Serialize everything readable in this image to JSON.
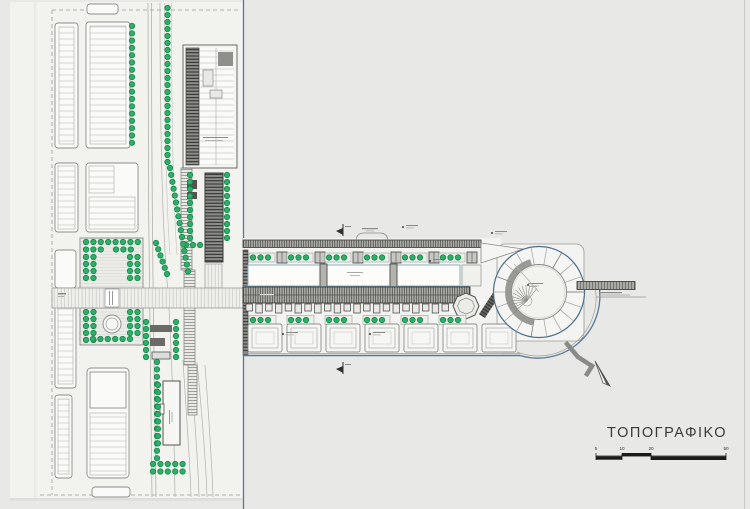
{
  "title": {
    "text": "ΤΟΠΟΓΡΑΦΙΚΟ"
  },
  "scale_bar": {
    "labels": [
      "5",
      "10",
      "20",
      "50"
    ]
  },
  "colors": {
    "background": "#e8e8e6",
    "paper": "#f2f2ef",
    "block_fill": "#fafaf8",
    "block_stroke": "#8e8e8a",
    "tree_fill": "#2fae68",
    "tree_stroke": "#15894c",
    "quay_blue": "#56789a",
    "hall_blue": "#8fb0c4",
    "dark_ink": "#3a3a38",
    "mid_ink": "#8a8a86",
    "scale_ink": "#1a1a1a"
  },
  "plan": {
    "tree_rows": [
      [
        132,
        26,
        0,
        7.3,
        17
      ],
      [
        167.5,
        8,
        0,
        7,
        23
      ],
      [
        186,
        245,
        7,
        0,
        3
      ],
      [
        190,
        175,
        0,
        7,
        10
      ],
      [
        227,
        175,
        0,
        7,
        10
      ],
      [
        170,
        168,
        1.2,
        6.9,
        16
      ],
      [
        156,
        243,
        2.2,
        6.2,
        6
      ],
      [
        146,
        322,
        0,
        7,
        6
      ],
      [
        176,
        322,
        0,
        7,
        6
      ],
      [
        86,
        242,
        7.4,
        0,
        8
      ],
      [
        86,
        249.5,
        7.4,
        0,
        3
      ],
      [
        116,
        249.5,
        7.4,
        0,
        3
      ],
      [
        86,
        257,
        0,
        7,
        4
      ],
      [
        93.5,
        257,
        0,
        7,
        4
      ],
      [
        130,
        257,
        0,
        7,
        4
      ],
      [
        137.5,
        257,
        0,
        7,
        4
      ],
      [
        86,
        312,
        0,
        7,
        5
      ],
      [
        93.5,
        312,
        0,
        7,
        5
      ],
      [
        130,
        312,
        0,
        7,
        4
      ],
      [
        137.5,
        312,
        0,
        7,
        4
      ],
      [
        93,
        339,
        7.4,
        0,
        6
      ],
      [
        157,
        362,
        0,
        7.4,
        14
      ],
      [
        153,
        464,
        7.4,
        0,
        5
      ],
      [
        153,
        471.5,
        7.4,
        0,
        5
      ],
      [
        158,
        385,
        0,
        7.3,
        9
      ],
      [
        253,
        257.5,
        7.5,
        0,
        3
      ],
      [
        291,
        257.5,
        7.5,
        0,
        3
      ],
      [
        329,
        257.5,
        7.5,
        0,
        3
      ],
      [
        367,
        257.5,
        7.5,
        0,
        3
      ],
      [
        405,
        257.5,
        7.5,
        0,
        3
      ],
      [
        443,
        257.5,
        7.5,
        0,
        3
      ],
      [
        253,
        320,
        7.5,
        0,
        3
      ],
      [
        291,
        320,
        7.5,
        0,
        3
      ],
      [
        329,
        320,
        7.5,
        0,
        3
      ],
      [
        367,
        320,
        7.5,
        0,
        3
      ],
      [
        405,
        320,
        7.5,
        0,
        3
      ],
      [
        443,
        320,
        7.5,
        0,
        3
      ]
    ],
    "platform_xs": [
      250,
      288,
      326,
      364,
      402,
      440
    ],
    "bay_squares": {
      "xs": [
        248,
        287,
        326,
        365,
        404,
        443,
        482
      ],
      "y": 324,
      "size": 34
    },
    "shops": {
      "x0": 246,
      "step": 9.8,
      "n": 21,
      "y": 304,
      "w": 6.5,
      "h": 9
    },
    "circle_building": {
      "cx": 539,
      "cy": 292,
      "r_outer": 45.5,
      "r_inner": 27.5,
      "spokes": 18
    },
    "fan": {
      "cx": 527,
      "cy": 301,
      "r": 16,
      "a0": 140,
      "a1": 310,
      "step": 14
    },
    "annotations": {
      "flags": [
        [
          336,
          228
        ],
        [
          336,
          366
        ]
      ],
      "ticks": [
        [
          403,
          225
        ],
        [
          492,
          231
        ],
        [
          430,
          259
        ],
        [
          283,
          332
        ],
        [
          370,
          332
        ],
        [
          528,
          283
        ]
      ]
    }
  }
}
